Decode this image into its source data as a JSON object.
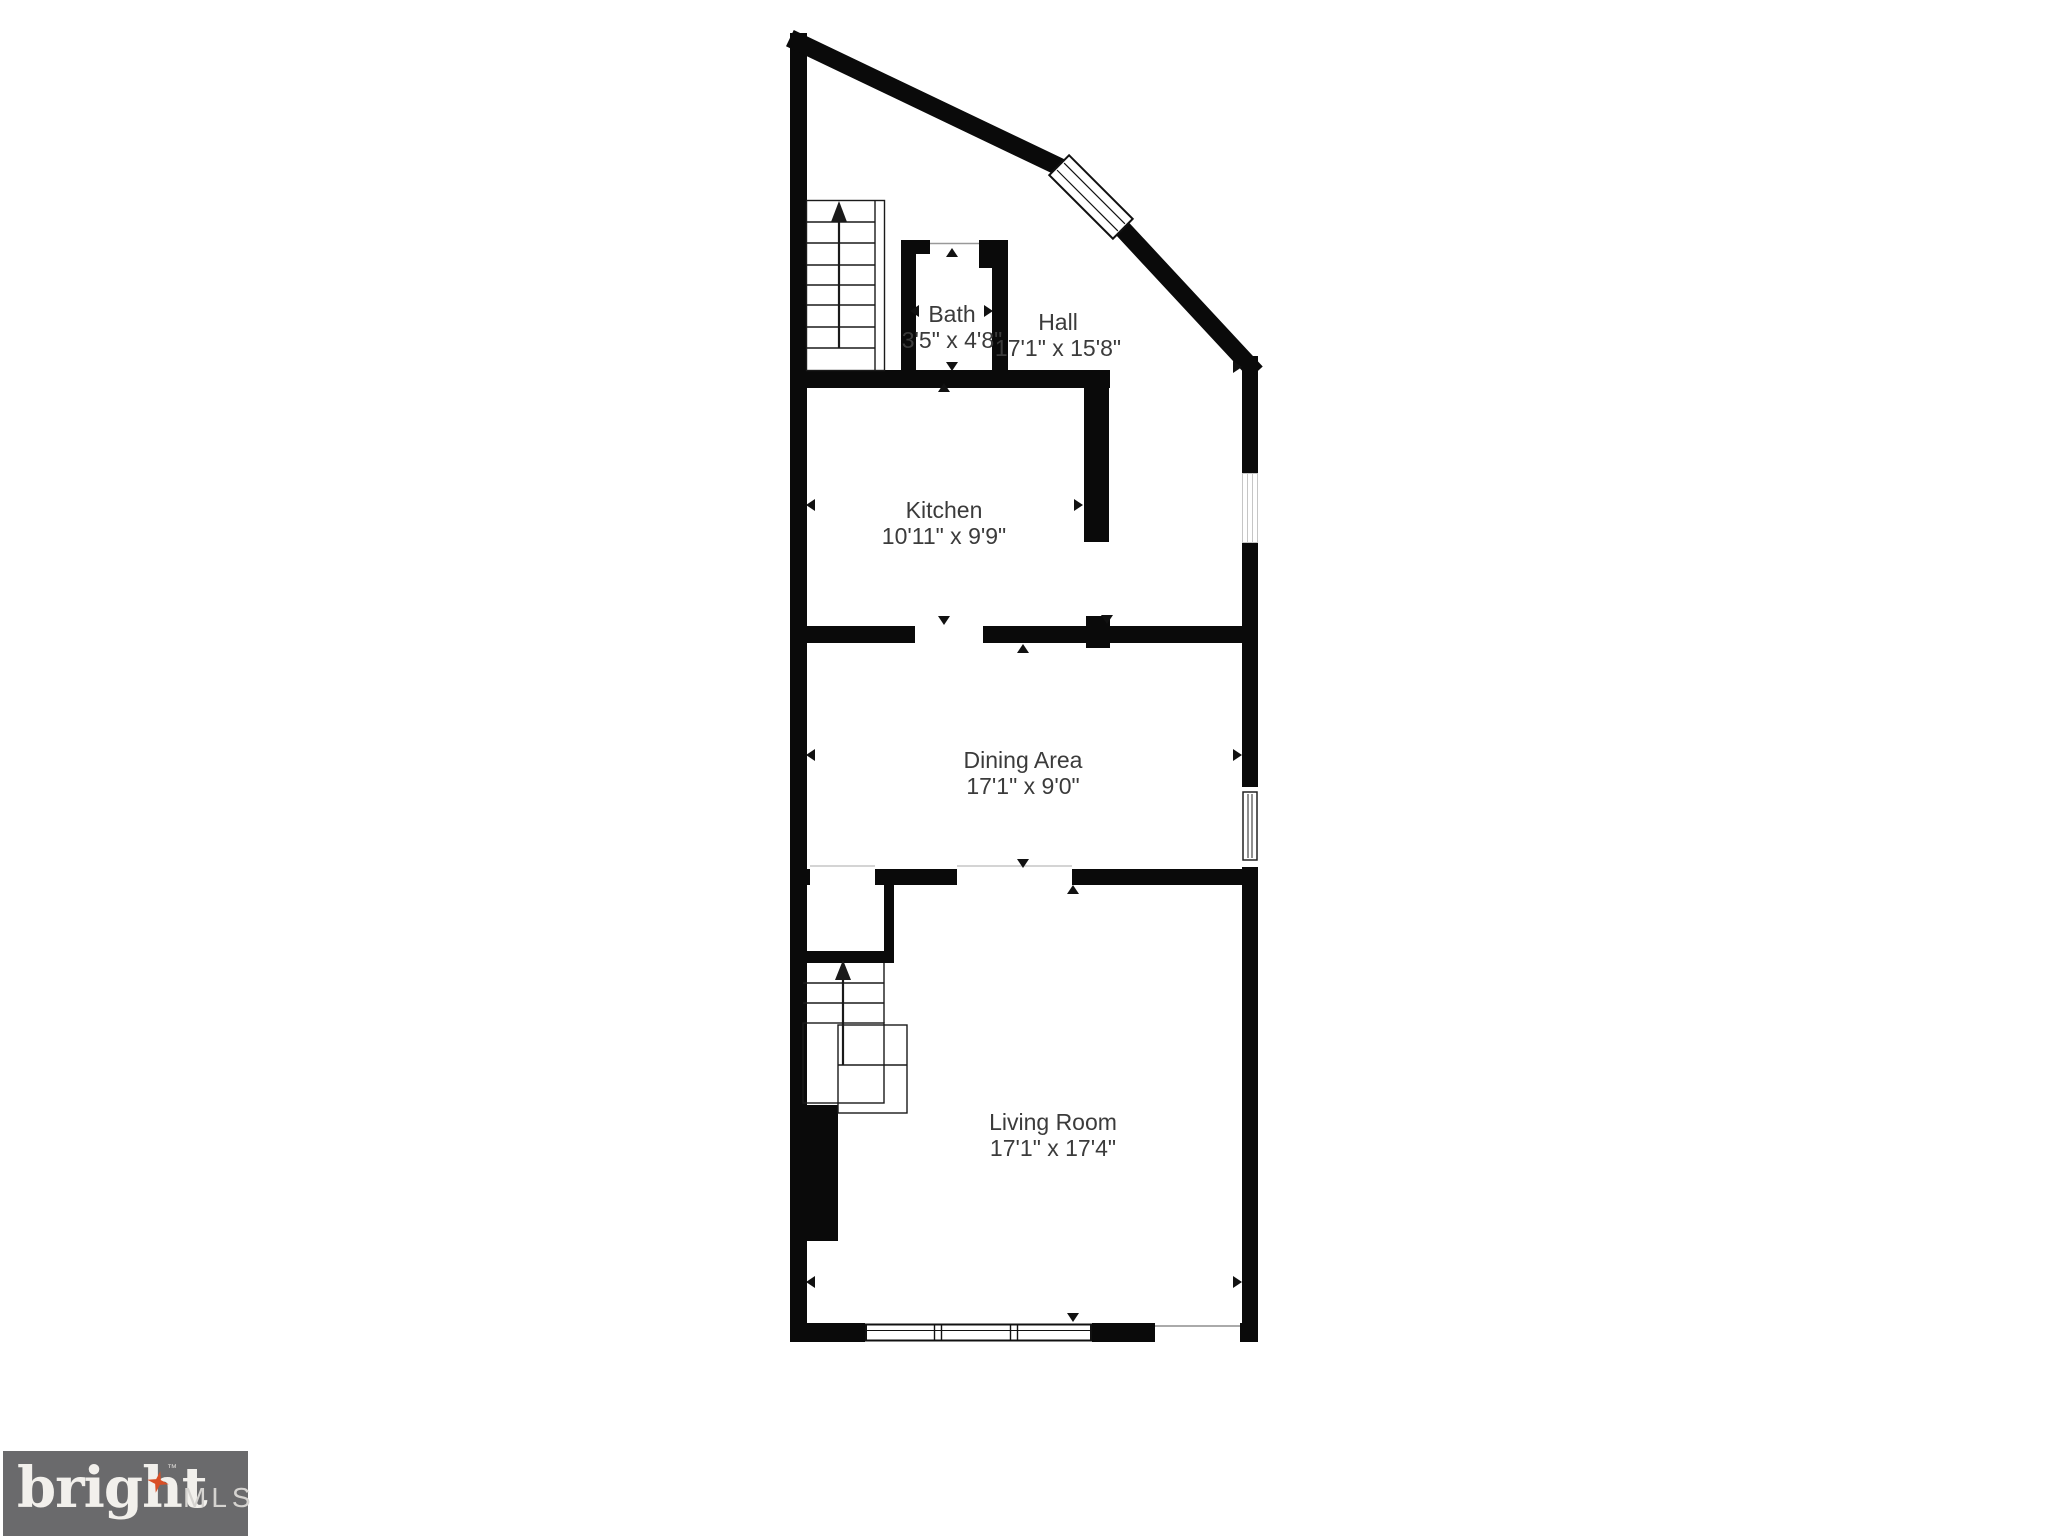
{
  "floor_plan": {
    "rooms": [
      {
        "id": "bath",
        "name": "Bath",
        "dimensions": "3'5\" x 4'8\""
      },
      {
        "id": "hall",
        "name": "Hall",
        "dimensions": "17'1\" x 15'8\""
      },
      {
        "id": "kitchen",
        "name": "Kitchen",
        "dimensions": "10'11\" x 9'9\""
      },
      {
        "id": "dining_area",
        "name": "Dining Area",
        "dimensions": "17'1\" x 9'0\""
      },
      {
        "id": "living_room",
        "name": "Living Room",
        "dimensions": "17'1\" x 17'4\""
      }
    ],
    "colors": {
      "wall": "#0a0a0a",
      "label_text": "#3b3b3b",
      "background": "#ffffff"
    },
    "icons": {
      "stairs-up-arrow": "▲",
      "dimension-arrow-up": "▲",
      "dimension-arrow-down": "▼",
      "dimension-arrow-left": "◀",
      "dimension-arrow-right": "▶"
    }
  },
  "branding": {
    "logo_word": "bright",
    "logo_trademark": "™",
    "logo_mls": "MLS",
    "colors": {
      "logo_background": "#6a6a6c",
      "logo_word_color": "#f2f0ec",
      "logo_mls_color": "#d5d3d0",
      "sparkle_color": "#d94f26"
    }
  }
}
